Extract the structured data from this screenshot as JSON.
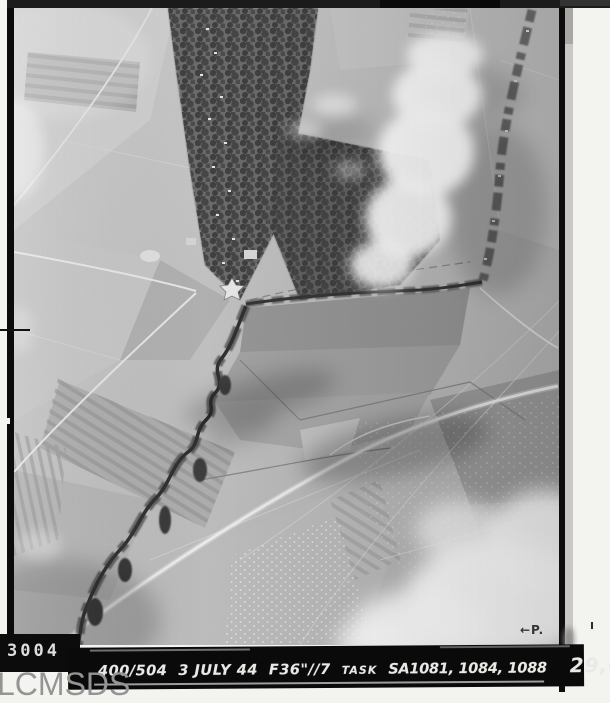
{
  "photo": {
    "frame_number": "3004",
    "print_mark": "←P."
  },
  "caption": {
    "sortie": "400/504",
    "date": "3 JULY 44",
    "camera": "F36\"//7",
    "task_label": "TASK",
    "task_numbers": "SA1081, 1084, 1088",
    "altitude": "29,000'"
  },
  "watermark": {
    "text": "LCMSDS"
  },
  "colors": {
    "page_background": "#f3f3f0",
    "film_black": "#0b0b0b",
    "caption_band": "#0a0a0a",
    "caption_text": "#e9e9e6",
    "frame_number_text": "#dedede",
    "watermark_gray": "#949494",
    "photo_base_gray": "#bdbdbd"
  }
}
